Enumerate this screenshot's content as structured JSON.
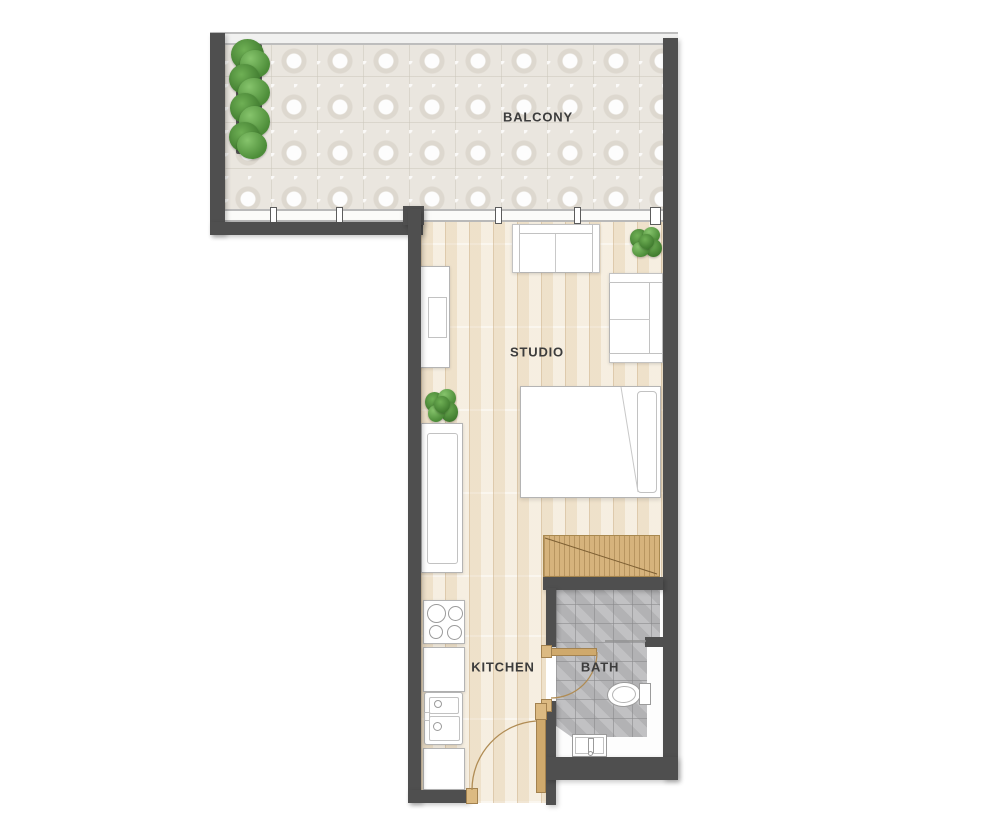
{
  "plan": {
    "type": "studio-apartment-floor-plan",
    "labels": {
      "balcony": "BALCONY",
      "studio": "STUDIO",
      "kitchen": "KITCHEN",
      "bath": "BATH"
    },
    "rooms": [
      {
        "id": "balcony",
        "features": [
          "tiled-floor",
          "planter",
          "glass-railing",
          "window-wall"
        ]
      },
      {
        "id": "studio",
        "features": [
          "wood-floor",
          "sofa",
          "armchair",
          "tv-unit",
          "bed",
          "pillow",
          "wardrobe",
          "plants"
        ]
      },
      {
        "id": "kitchen",
        "features": [
          "counter",
          "stove-4-burners",
          "double-sink",
          "entrance-door"
        ]
      },
      {
        "id": "bath",
        "features": [
          "gray-tile-floor",
          "toilet",
          "sink",
          "shower-partition",
          "door"
        ]
      }
    ],
    "palette": {
      "wall": "#4f4f4f",
      "wood_floor": "#f4ead9",
      "balcony_tile": "#eae6df",
      "bath_tile": "#bcbcbe",
      "wardrobe_wood": "#d6b37c",
      "door_wood": "#cfa96c",
      "plant_green": "#4c8c38",
      "furniture_outline": "#b4b4b4",
      "label_text": "#3c3c3c",
      "background": "#ffffff"
    }
  }
}
